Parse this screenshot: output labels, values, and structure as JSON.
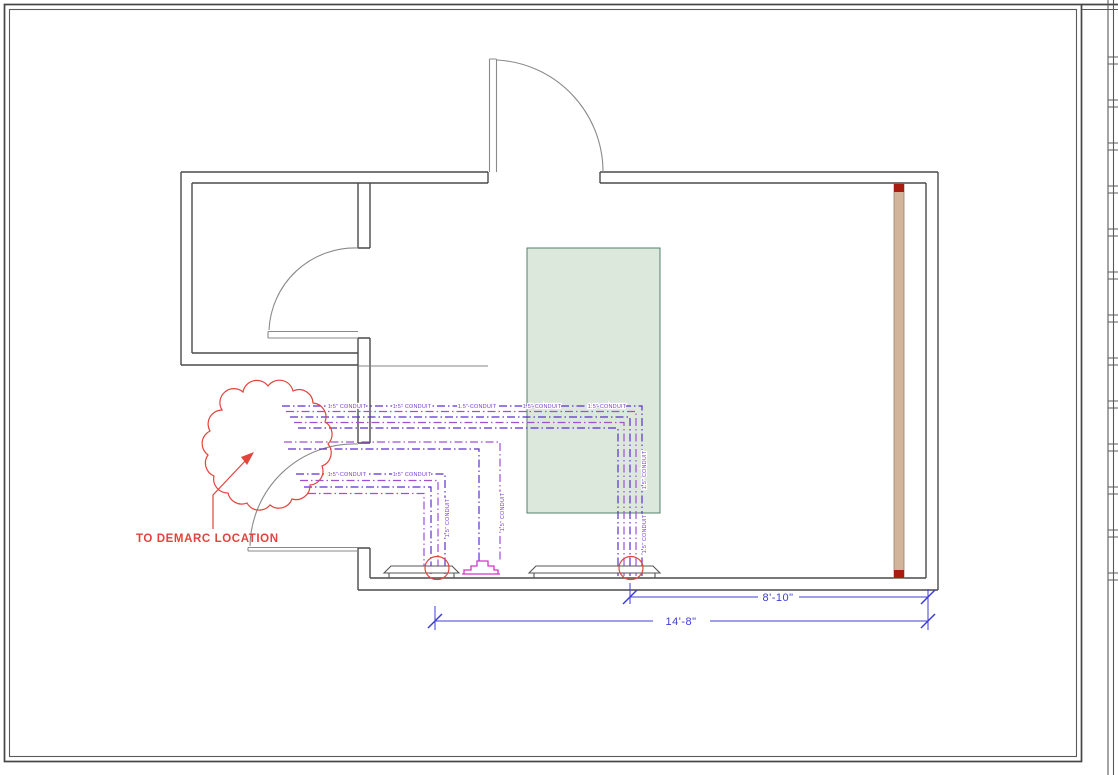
{
  "sheet": {
    "background": "#ffffff",
    "border_color": "#454545"
  },
  "labels": {
    "demarc": "TO DEMARC LOCATION",
    "conduit": "1.5\" CONDUIT"
  },
  "dimensions": {
    "inner": "8'-10\"",
    "outer": "14'-8\""
  },
  "colors": {
    "wall": "#4a4a4a",
    "door": "#8a8a8a",
    "annotation_red": "#e0453c",
    "conduit_blue": "#5b2fd0",
    "conduit_violet": "#a14fd6",
    "conduit_magenta": "#d633c8",
    "dimension_blue": "#3d3dd6",
    "equipment_fill": "#dce8dc",
    "equipment_border": "#55806b",
    "backboard_tan": "#d2b49a",
    "backboard_cap_red": "#a81d10"
  }
}
